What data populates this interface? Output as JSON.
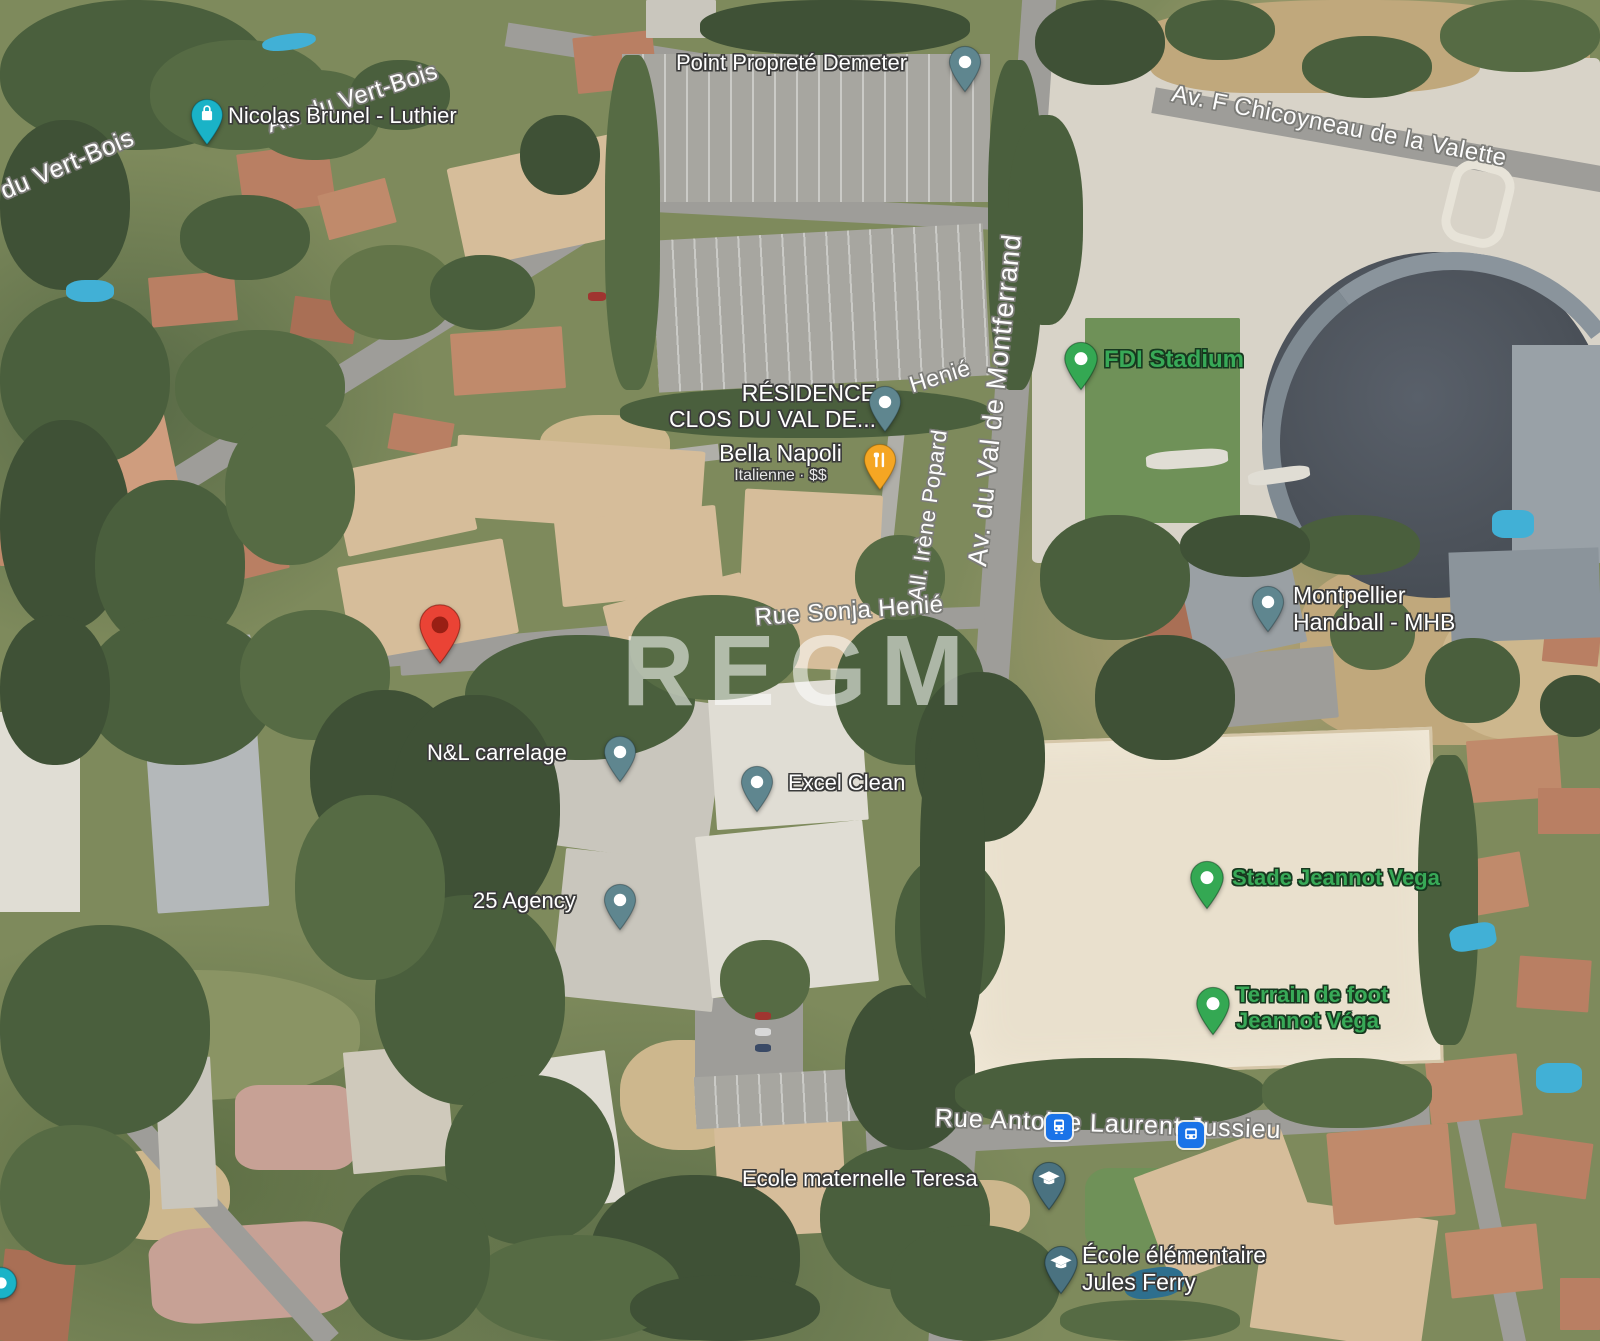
{
  "watermark": "REGM",
  "road_labels": {
    "vert_bois_top": "Av. du Vert-Bois",
    "vert_bois_left": "du Vert-Bois",
    "chicoyneau": "Av. F Chicoyneau de la Valette",
    "montferrand": "Av. du Val de Montferrand",
    "popard": "All. Irène Popard",
    "henie_small": "Henié",
    "sonja_henie": "Rue Sonja Henié",
    "jussieu": "Rue Antoine Laurent Jussieu"
  },
  "places": {
    "nicolas_brunel": {
      "label": "Nicolas Brunel - Luthier"
    },
    "point_proprete": {
      "label": "Point Propreté Demeter"
    },
    "residence": {
      "line1": "RÉSIDENCE",
      "line2": "CLOS DU VAL DE..."
    },
    "bella_napoli": {
      "label": "Bella Napoli",
      "sub": "Italienne · $$"
    },
    "fdi_stadium": {
      "label": "FDI Stadium"
    },
    "mhb": {
      "line1": "Montpellier",
      "line2": "Handball - MHB"
    },
    "nl_carrelage": {
      "label": "N&L carrelage"
    },
    "excel_clean": {
      "label": "Excel Clean"
    },
    "agency25": {
      "label": "25 Agency"
    },
    "stade_vega": {
      "label": "Stade Jeannot Vega"
    },
    "terrain_foot": {
      "line1": "Terrain de foot",
      "line2": "Jeannot Véga"
    },
    "ecole_maternelle": {
      "label": "Ecole maternelle Teresa"
    },
    "ecole_elementaire": {
      "line1": "École élémentaire",
      "line2": "Jules Ferry"
    }
  },
  "colors": {
    "shop_marker": "#1ab3c7",
    "poi_marker": "#5f868f",
    "school_marker": "#4a7280",
    "green_marker": "#34a853",
    "restaurant_marker": "#f5a623",
    "destination_pin": "#ea4335",
    "destination_pin_inner": "#991f14",
    "transit_icon": "#1a73e8",
    "green_label_text": "#38a957"
  }
}
